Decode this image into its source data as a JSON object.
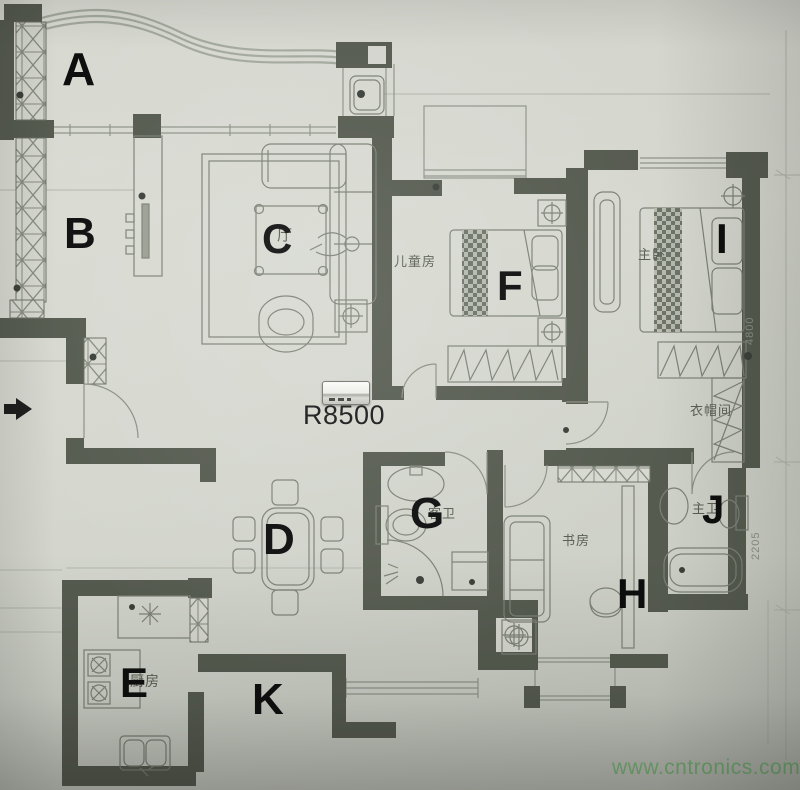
{
  "markers": {
    "a": "A",
    "b": "B",
    "c": "C",
    "d": "D",
    "e": "E",
    "f": "F",
    "g": "G",
    "h": "H",
    "i": "I",
    "j": "J",
    "k": "K"
  },
  "rooms": {
    "living": "厅",
    "children": "儿童房",
    "master": "主卧",
    "cloak": "衣帽间",
    "study": "书房",
    "kitchen": "厨房",
    "guest_bath": "客卫",
    "master_bath": "主卫"
  },
  "device": {
    "label": "R8500",
    "icon": "wifi-router-photo"
  },
  "dimensions": {
    "upper": "4800",
    "lower": "2205"
  },
  "watermark": {
    "text": "www.cntronics.com"
  },
  "colors": {
    "wall": "#565b50",
    "paper": "#d6d8d0",
    "letters": "#0d0d0d",
    "room_text": "#595e54",
    "watermark_green": "#79ba79"
  }
}
